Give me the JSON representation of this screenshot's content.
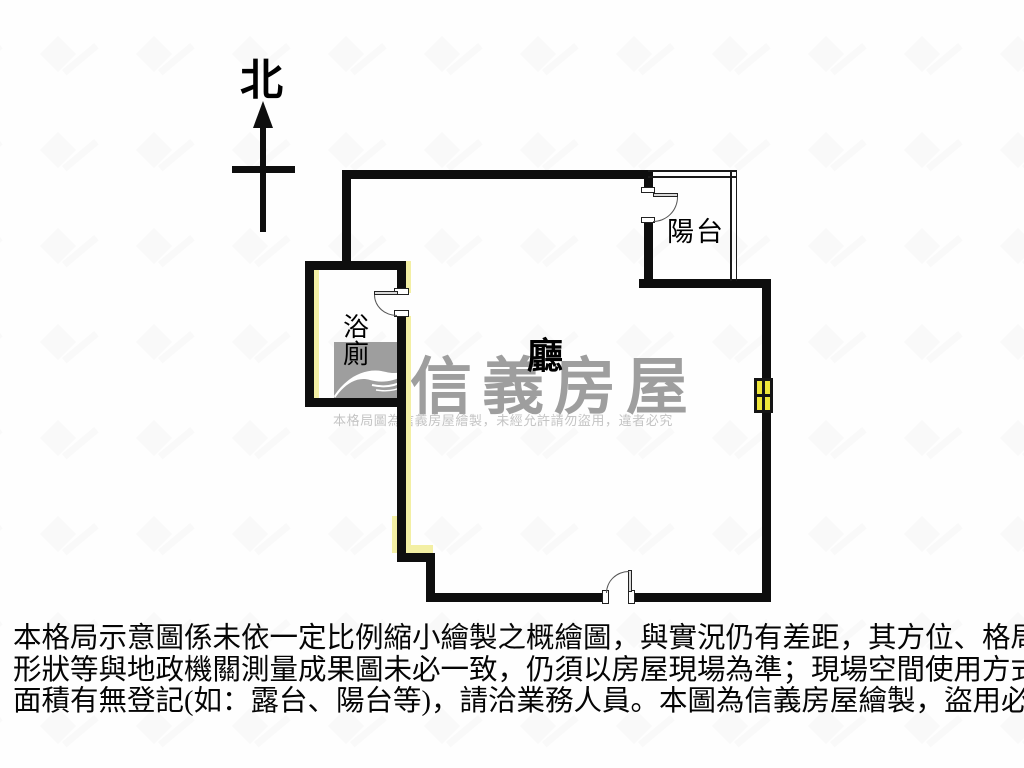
{
  "compass": {
    "label": "北"
  },
  "rooms": {
    "living": "廳",
    "balcony": "陽台",
    "bathroom_line1": "浴",
    "bathroom_line2": "廁"
  },
  "watermark": {
    "brand": "信義房屋",
    "notice": "本格局圖為信義房屋繪製，未經允許請勿盜用，違者必究"
  },
  "disclaimer": {
    "lines": [
      "本格局示意圖係未依一定比例縮小繪製之概繪圖，與實況仍有差距，其方位、格局、",
      "形狀等與地政機關測量成果圖未必一致，仍須以房屋現場為準；現場空間使用方式及",
      "面積有無登記(如：露台、陽台等)，請洽業務人員。本圖為信義房屋繪製，盜用必究。"
    ]
  },
  "colors": {
    "wall": "#0e0e0e",
    "window_yellow": "#eee63a",
    "wall_accent_yellow": "#f3efa4",
    "brand_gray": "#9e9e9e",
    "notice_gray": "#c4c4c4",
    "background": "#fefefe"
  }
}
